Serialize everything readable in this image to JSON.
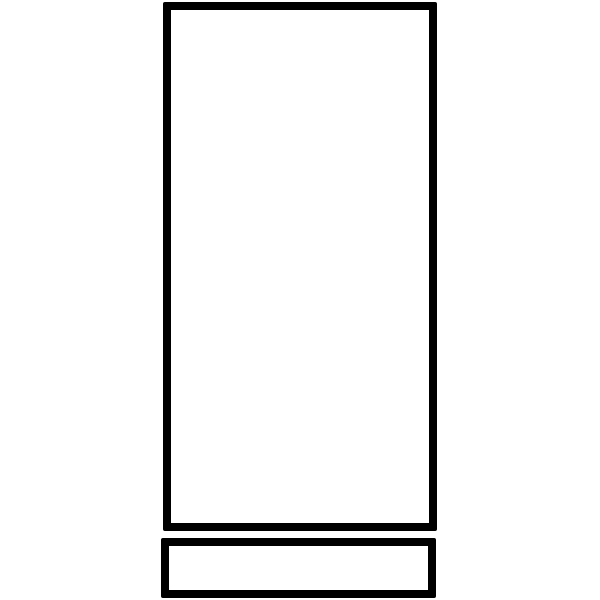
{
  "canvas": {
    "width": 600,
    "height": 600,
    "background": "#ffffff"
  },
  "drawing": {
    "description": "Black outline sketch of a tall vertical rectangle with a short wide rectangle beneath it",
    "stroke_color": "#000000",
    "shapes": [
      {
        "name": "tall-rectangle-outline",
        "x": 163,
        "y": 2,
        "width": 274,
        "height": 529,
        "stroke_width": 8
      },
      {
        "name": "base-rectangle-outline",
        "x": 161,
        "y": 538,
        "width": 275,
        "height": 60,
        "stroke_width": 8
      }
    ]
  }
}
